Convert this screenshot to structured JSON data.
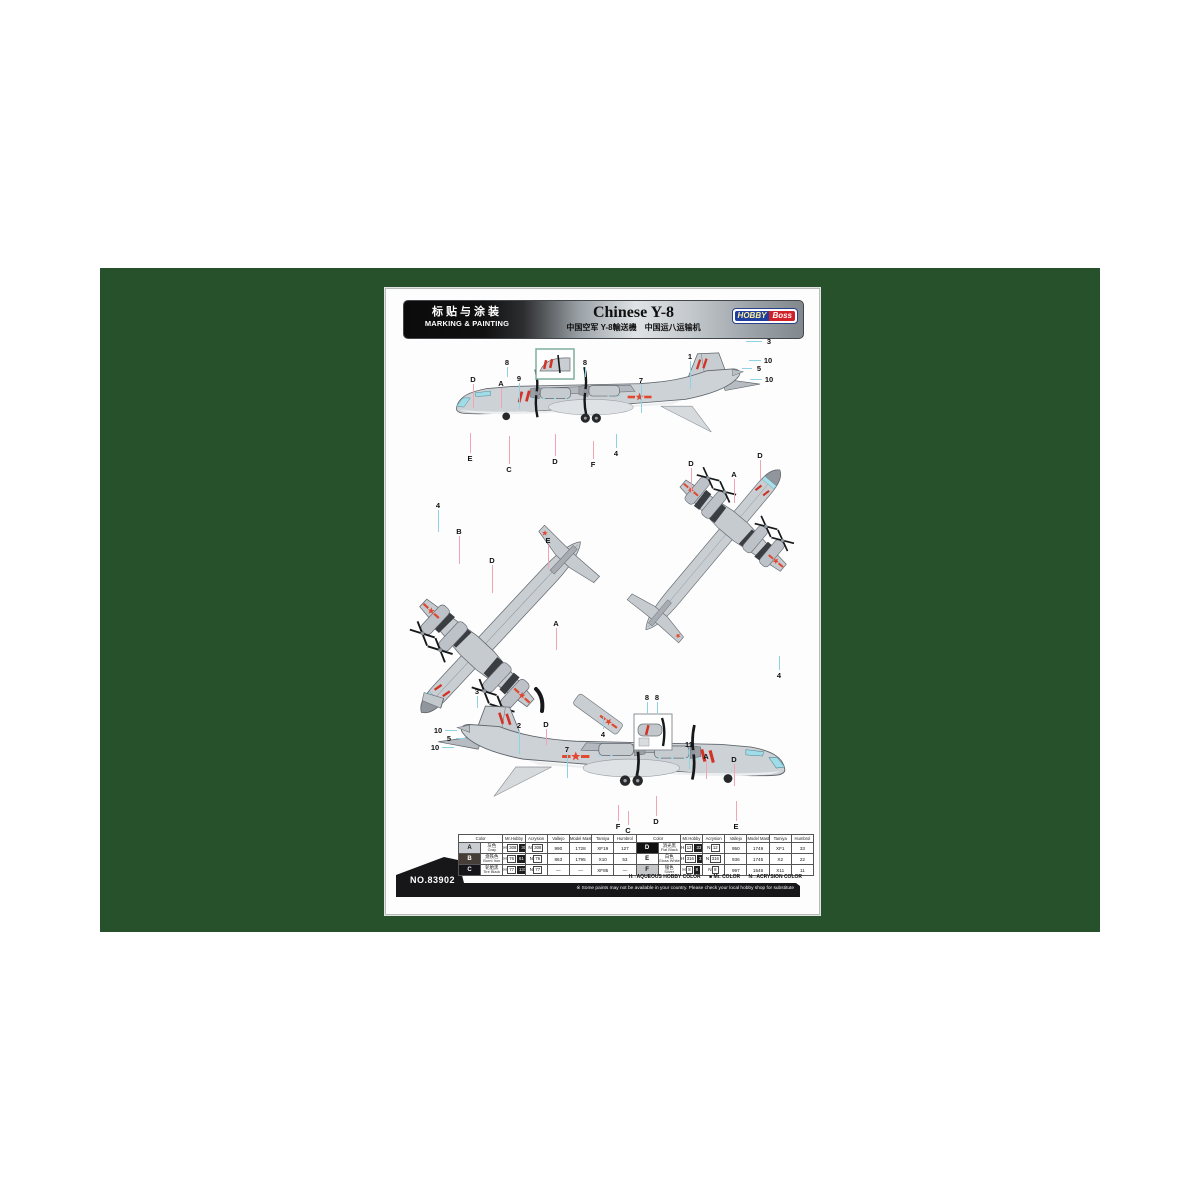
{
  "page": {
    "header": {
      "left_cn": "标贴与涂装",
      "left_en": "MARKING & PAINTING",
      "title": "Chinese Y-8",
      "subtitle": "中国空军 Y-8輸送機　中国运八运输机",
      "logo": {
        "part1": "HOBBY",
        "part2": "Boss"
      }
    },
    "kit_no": "NO.83902",
    "legend": {
      "h": "H□ AQUEOUS HOBBY COLOR",
      "mr": "■ Mr. COLOR",
      "n": "N□ ACRYSION COLOR"
    },
    "footnote": "※ Some paints may not be available in your country. Please check your local hobby shop for substitute"
  },
  "diagram": {
    "views": [
      "left side view",
      "bottom plan view",
      "top plan view",
      "right side view"
    ],
    "insets": [
      "nose detail",
      "engine nacelle detail"
    ]
  },
  "colors": {
    "green_bg": "#27512a",
    "number_line": "#8ed2e4",
    "letter_line": "#f0a4b4",
    "marking_red": "#d23325",
    "aircraft_gray": "#cdd2d6"
  },
  "table": {
    "headers": [
      "Color",
      "Mr.Hobby",
      "Acrysion",
      "Vallejo",
      "Model Master",
      "Tamiya",
      "Humbrol"
    ],
    "rows": [
      {
        "letter": "A",
        "swatch": "#c9cdd1",
        "text_color": "#111111",
        "name_cn": "灰色",
        "name_en": "Gray",
        "mh_h": "308",
        "mh_c": "308",
        "acrysion": "308",
        "vallejo": "990",
        "model_master": "1728",
        "tamiya": "XF19",
        "humbrol": "127"
      },
      {
        "letter": "B",
        "swatch": "#463d36",
        "text_color": "#ffffff",
        "name_cn": "烧铁色",
        "name_en": "Burnt Iron",
        "mh_h": "76",
        "mh_c": "61",
        "acrysion": "76",
        "vallejo": "863",
        "model_master": "1795",
        "tamiya": "X10",
        "humbrol": "53"
      },
      {
        "letter": "C",
        "swatch": "#15151a",
        "text_color": "#ffffff",
        "name_cn": "轮胎黑",
        "name_en": "Tire Black",
        "mh_h": "77",
        "mh_c": "137",
        "acrysion": "77",
        "vallejo": "—",
        "model_master": "—",
        "tamiya": "XF85",
        "humbrol": "—"
      },
      {
        "letter": "D",
        "swatch": "#101010",
        "text_color": "#ffffff",
        "name_cn": "消光黑",
        "name_en": "Flat Black",
        "mh_h": "12",
        "mh_c": "33",
        "acrysion": "12",
        "vallejo": "950",
        "model_master": "1749",
        "tamiya": "XF1",
        "humbrol": "33"
      },
      {
        "letter": "E",
        "swatch": "#ffffff",
        "text_color": "#111111",
        "name_cn": "白色",
        "name_en": "Gloss White",
        "mh_h": "316",
        "mh_c": "316",
        "acrysion": "316",
        "vallejo": "936",
        "model_master": "1745",
        "tamiya": "X2",
        "humbrol": "22"
      },
      {
        "letter": "F",
        "swatch": "#c4c6c8",
        "text_color": "#111111",
        "name_cn": "银色",
        "name_en": "Silver",
        "mh_h": "8",
        "mh_c": "8",
        "acrysion": "8",
        "vallejo": "997",
        "model_master": "1546",
        "tamiya": "X11",
        "humbrol": "11"
      }
    ]
  },
  "callouts": [
    {
      "t": "D",
      "x": 87,
      "y": 90,
      "dir": "down",
      "len": 24
    },
    {
      "t": "A",
      "x": 115,
      "y": 94,
      "dir": "down",
      "len": 20
    },
    {
      "t": "9",
      "x": 133,
      "y": 89,
      "dir": "down",
      "len": 26
    },
    {
      "t": "8",
      "x": 121,
      "y": 73,
      "dir": "down",
      "len": 10
    },
    {
      "t": "8",
      "x": 199,
      "y": 73,
      "dir": "down",
      "len": 10
    },
    {
      "t": "7",
      "x": 255,
      "y": 91,
      "dir": "down",
      "len": 28
    },
    {
      "t": "1",
      "x": 304,
      "y": 67,
      "dir": "down",
      "len": 28
    },
    {
      "t": "3",
      "x": 383,
      "y": 52,
      "dir": "left",
      "len": 16
    },
    {
      "t": "10",
      "x": 382,
      "y": 71,
      "dir": "left",
      "len": 12
    },
    {
      "t": "5",
      "x": 373,
      "y": 79,
      "dir": "left",
      "len": 10
    },
    {
      "t": "10",
      "x": 383,
      "y": 90,
      "dir": "left",
      "len": 12
    },
    {
      "t": "E",
      "x": 84,
      "y": 169,
      "dir": "up",
      "len": 20
    },
    {
      "t": "C",
      "x": 123,
      "y": 180,
      "dir": "up",
      "len": 28
    },
    {
      "t": "D",
      "x": 169,
      "y": 172,
      "dir": "up",
      "len": 22
    },
    {
      "t": "F",
      "x": 207,
      "y": 175,
      "dir": "up",
      "len": 18
    },
    {
      "t": "4",
      "x": 230,
      "y": 164,
      "dir": "up",
      "len": 14
    },
    {
      "t": "D",
      "x": 305,
      "y": 174,
      "dir": "down",
      "len": 24
    },
    {
      "t": "A",
      "x": 348,
      "y": 185,
      "dir": "down",
      "len": 24
    },
    {
      "t": "D",
      "x": 374,
      "y": 166,
      "dir": "down",
      "len": 20
    },
    {
      "t": "4",
      "x": 393,
      "y": 386,
      "dir": "up",
      "len": 14
    },
    {
      "t": "4",
      "x": 52,
      "y": 216,
      "dir": "down",
      "len": 22
    },
    {
      "t": "B",
      "x": 73,
      "y": 242,
      "dir": "down",
      "len": 28
    },
    {
      "t": "D",
      "x": 106,
      "y": 271,
      "dir": "down",
      "len": 28
    },
    {
      "t": "E",
      "x": 162,
      "y": 251,
      "dir": "down",
      "len": 24
    },
    {
      "t": "A",
      "x": 170,
      "y": 334,
      "dir": "down",
      "len": 22
    },
    {
      "t": "3",
      "x": 91,
      "y": 402,
      "dir": "down",
      "len": 12
    },
    {
      "t": "2",
      "x": 133,
      "y": 436,
      "dir": "down",
      "len": 24
    },
    {
      "t": "D",
      "x": 160,
      "y": 435,
      "dir": "down",
      "len": 16
    },
    {
      "t": "4",
      "x": 217,
      "y": 445,
      "dir": "up",
      "len": 12
    },
    {
      "t": "8",
      "x": 261,
      "y": 408,
      "dir": "down",
      "len": 12
    },
    {
      "t": "8",
      "x": 271,
      "y": 408,
      "dir": "down",
      "len": 12
    },
    {
      "t": "7",
      "x": 181,
      "y": 460,
      "dir": "down",
      "len": 24
    },
    {
      "t": "11",
      "x": 303,
      "y": 455,
      "dir": "down",
      "len": 20
    },
    {
      "t": "A",
      "x": 320,
      "y": 467,
      "dir": "down",
      "len": 18
    },
    {
      "t": "D",
      "x": 348,
      "y": 470,
      "dir": "down",
      "len": 22
    },
    {
      "t": "10",
      "x": 52,
      "y": 441,
      "dir": "right",
      "len": 12
    },
    {
      "t": "5",
      "x": 63,
      "y": 449,
      "dir": "right",
      "len": 10
    },
    {
      "t": "10",
      "x": 49,
      "y": 458,
      "dir": "right",
      "len": 12
    },
    {
      "t": "F",
      "x": 232,
      "y": 537,
      "dir": "up",
      "len": 16
    },
    {
      "t": "C",
      "x": 242,
      "y": 541,
      "dir": "up",
      "len": 14
    },
    {
      "t": "D",
      "x": 270,
      "y": 532,
      "dir": "up",
      "len": 20
    },
    {
      "t": "E",
      "x": 350,
      "y": 537,
      "dir": "up",
      "len": 20
    }
  ]
}
